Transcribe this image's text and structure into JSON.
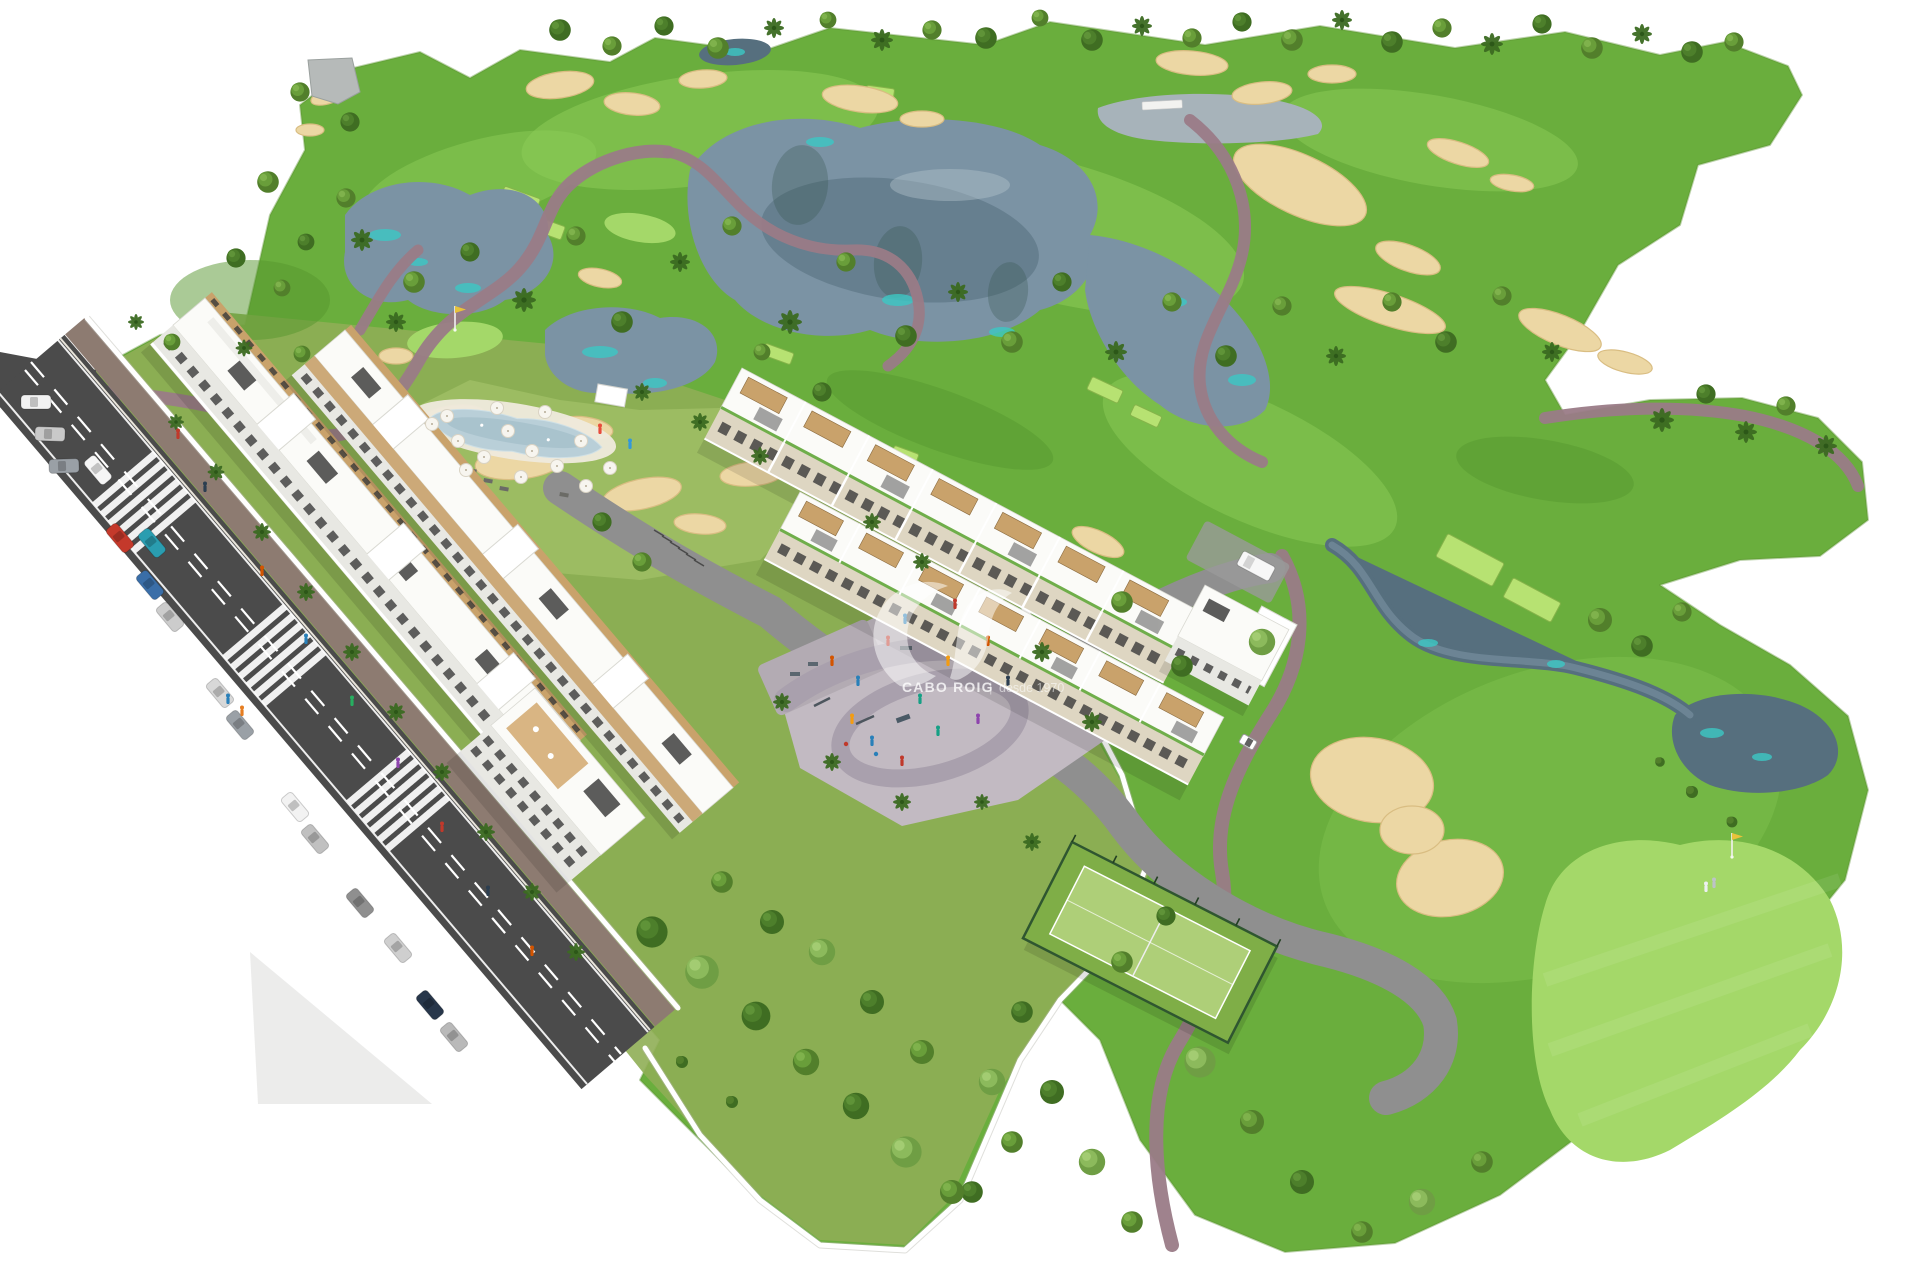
{
  "watermark": {
    "brand": "CABO ROIG",
    "divider": "|",
    "tagline": "desde 1970",
    "logo": "swoosh-logo"
  },
  "colors": {
    "grass": "#6aae3d",
    "fairway": "#8ccc58",
    "rough": "#55962e",
    "lawn": "#8fae55",
    "lawn2": "#9cbc62",
    "green": "#a4d869",
    "tee": "#b7e272",
    "sand": "#ecd7a4",
    "sandedge": "#d9bd82",
    "water": "#7b93a4",
    "waterdeep": "#566f7e",
    "teal": "#3cc8c4",
    "pathm": "#9a7b87",
    "road": "#4b4b4b",
    "sidewalk": "#8d7b71",
    "plaza": "#c2bac2",
    "plazapath": "#a9a0ad",
    "court": "#7fae47",
    "courtin": "#aecf78",
    "fence": "#2f5630",
    "balcony": "#c9a26b",
    "window": "#3a3a3a",
    "roofbox": "#3f3f3f",
    "pool": "#b9cfd8",
    "deck": "#efeadd",
    "drive": "#8f8f8f",
    "wall": "#ffffff",
    "building": "#fbfbf8",
    "flag": "#e8c33a"
  },
  "scene": {
    "trees": [
      [
        "d",
        560,
        30,
        0.9
      ],
      [
        "m",
        612,
        46,
        0.8
      ],
      [
        "d",
        664,
        26,
        0.8
      ],
      [
        "m",
        718,
        48,
        0.9
      ],
      [
        "p",
        774,
        28,
        1.0
      ],
      [
        "m",
        828,
        20,
        0.7
      ],
      [
        "p",
        882,
        40,
        1.1
      ],
      [
        "m",
        932,
        30,
        0.8
      ],
      [
        "d",
        986,
        38,
        0.9
      ],
      [
        "m",
        1040,
        18,
        0.7
      ],
      [
        "d",
        1092,
        40,
        0.9
      ],
      [
        "p",
        1142,
        26,
        1.0
      ],
      [
        "m",
        1192,
        38,
        0.8
      ],
      [
        "d",
        1242,
        22,
        0.8
      ],
      [
        "m",
        1292,
        40,
        0.9
      ],
      [
        "p",
        1342,
        20,
        1.0
      ],
      [
        "d",
        1392,
        42,
        0.9
      ],
      [
        "m",
        1442,
        28,
        0.8
      ],
      [
        "p",
        1492,
        44,
        1.1
      ],
      [
        "d",
        1542,
        24,
        0.8
      ],
      [
        "m",
        1592,
        48,
        0.9
      ],
      [
        "p",
        1642,
        34,
        1.0
      ],
      [
        "d",
        1692,
        52,
        0.9
      ],
      [
        "m",
        1734,
        42,
        0.8
      ],
      [
        "m",
        300,
        92,
        0.8
      ],
      [
        "d",
        350,
        122,
        0.8
      ],
      [
        "m",
        268,
        182,
        0.9
      ],
      [
        "d",
        236,
        258,
        0.8
      ],
      [
        "m",
        282,
        288,
        0.7
      ],
      [
        "p",
        362,
        240,
        1.1
      ],
      [
        "m",
        414,
        282,
        0.9
      ],
      [
        "d",
        470,
        252,
        0.8
      ],
      [
        "p",
        524,
        300,
        1.2
      ],
      [
        "m",
        576,
        236,
        0.8
      ],
      [
        "d",
        622,
        322,
        0.9
      ],
      [
        "p",
        680,
        262,
        1.0
      ],
      [
        "m",
        732,
        226,
        0.8
      ],
      [
        "p",
        790,
        322,
        1.2
      ],
      [
        "m",
        846,
        262,
        0.8
      ],
      [
        "d",
        906,
        336,
        0.9
      ],
      [
        "p",
        958,
        292,
        1.0
      ],
      [
        "m",
        1012,
        342,
        0.9
      ],
      [
        "d",
        1062,
        282,
        0.8
      ],
      [
        "p",
        1116,
        352,
        1.1
      ],
      [
        "m",
        1172,
        302,
        0.8
      ],
      [
        "d",
        1226,
        356,
        0.9
      ],
      [
        "m",
        1282,
        306,
        0.8
      ],
      [
        "p",
        1336,
        356,
        1.0
      ],
      [
        "m",
        1392,
        302,
        0.8
      ],
      [
        "d",
        1446,
        342,
        0.9
      ],
      [
        "m",
        1502,
        296,
        0.8
      ],
      [
        "p",
        1552,
        352,
        1.0
      ],
      [
        "m",
        346,
        198,
        0.8
      ],
      [
        "p",
        396,
        322,
        1.0
      ],
      [
        "d",
        306,
        242,
        0.7
      ],
      [
        "p",
        1662,
        420,
        1.2
      ],
      [
        "d",
        1706,
        394,
        0.8
      ],
      [
        "p",
        1746,
        432,
        1.1
      ],
      [
        "m",
        1786,
        406,
        0.8
      ],
      [
        "p",
        1826,
        446,
        1.1
      ],
      [
        "m",
        1600,
        620,
        1.0
      ],
      [
        "d",
        1642,
        646,
        0.9
      ],
      [
        "m",
        1682,
        612,
        0.8
      ],
      [
        "l",
        1262,
        642,
        1.1
      ],
      [
        "m",
        1122,
        602,
        0.9
      ],
      [
        "d",
        1182,
        666,
        0.9
      ],
      [
        "l",
        1200,
        1062,
        1.3
      ],
      [
        "m",
        1252,
        1122,
        1.0
      ],
      [
        "d",
        1302,
        1182,
        1.0
      ],
      [
        "m",
        1362,
        1232,
        0.9
      ],
      [
        "l",
        1422,
        1202,
        1.1
      ],
      [
        "m",
        1482,
        1162,
        0.9
      ],
      [
        "b",
        1692,
        792,
        1.0
      ],
      [
        "b",
        1732,
        822,
        0.9
      ],
      [
        "b",
        1660,
        762,
        0.8
      ],
      [
        "d",
        1052,
        1092,
        1.0
      ],
      [
        "m",
        1012,
        1142,
        0.9
      ],
      [
        "d",
        972,
        1192,
        0.9
      ],
      [
        "l",
        1092,
        1162,
        1.1
      ],
      [
        "m",
        1132,
        1222,
        0.9
      ],
      [
        "d",
        652,
        932,
        1.3
      ],
      [
        "l",
        702,
        972,
        1.4
      ],
      [
        "d",
        756,
        1016,
        1.2
      ],
      [
        "m",
        806,
        1062,
        1.1
      ],
      [
        "d",
        856,
        1106,
        1.1
      ],
      [
        "l",
        906,
        1152,
        1.3
      ],
      [
        "m",
        952,
        1192,
        1.0
      ],
      [
        "d",
        872,
        1002,
        1.0
      ],
      [
        "m",
        922,
        1052,
        1.0
      ],
      [
        "l",
        822,
        952,
        1.1
      ],
      [
        "d",
        772,
        922,
        1.0
      ],
      [
        "m",
        722,
        882,
        0.9
      ],
      [
        "b",
        682,
        1062,
        1.0
      ],
      [
        "b",
        732,
        1102,
        1.0
      ],
      [
        "l",
        992,
        1082,
        1.1
      ],
      [
        "d",
        1022,
        1012,
        0.9
      ],
      [
        "p",
        176,
        422,
        0.8
      ],
      [
        "p",
        216,
        472,
        0.85
      ],
      [
        "p",
        262,
        532,
        0.9
      ],
      [
        "p",
        306,
        592,
        0.9
      ],
      [
        "p",
        352,
        652,
        0.9
      ],
      [
        "p",
        396,
        712,
        0.9
      ],
      [
        "p",
        442,
        772,
        0.9
      ],
      [
        "p",
        486,
        832,
        0.9
      ],
      [
        "p",
        532,
        892,
        0.9
      ],
      [
        "p",
        576,
        952,
        0.9
      ],
      [
        "p",
        136,
        322,
        0.8
      ],
      [
        "m",
        172,
        342,
        0.7
      ],
      [
        "p",
        244,
        348,
        0.85
      ],
      [
        "m",
        302,
        354,
        0.7
      ],
      [
        "p",
        642,
        392,
        0.9
      ],
      [
        "p",
        700,
        422,
        0.9
      ],
      [
        "p",
        760,
        456,
        0.9
      ],
      [
        "d",
        602,
        522,
        0.8
      ],
      [
        "m",
        642,
        562,
        0.8
      ],
      [
        "p",
        872,
        522,
        0.9
      ],
      [
        "p",
        922,
        562,
        0.9
      ],
      [
        "p",
        1042,
        652,
        1.0
      ],
      [
        "p",
        1092,
        722,
        1.0
      ],
      [
        "p",
        832,
        762,
        0.9
      ],
      [
        "p",
        782,
        702,
        0.9
      ],
      [
        "p",
        902,
        802,
        0.9
      ],
      [
        "m",
        762,
        352,
        0.7
      ],
      [
        "d",
        822,
        392,
        0.8
      ],
      [
        "p",
        1032,
        842,
        0.9
      ],
      [
        "p",
        982,
        802,
        0.8
      ],
      [
        "m",
        1122,
        962,
        0.9
      ],
      [
        "d",
        1166,
        916,
        0.8
      ]
    ],
    "bunkers": [
      [
        560,
        85,
        34,
        13,
        -8
      ],
      [
        632,
        104,
        28,
        11,
        6
      ],
      [
        703,
        79,
        24,
        9,
        -4
      ],
      [
        860,
        99,
        38,
        13,
        8
      ],
      [
        922,
        119,
        22,
        8,
        0
      ],
      [
        1192,
        63,
        36,
        12,
        5
      ],
      [
        1262,
        93,
        30,
        11,
        -6
      ],
      [
        1332,
        74,
        24,
        9,
        0
      ],
      [
        1458,
        153,
        32,
        11,
        18
      ],
      [
        1512,
        183,
        22,
        8,
        10
      ],
      [
        1560,
        330,
        44,
        15,
        22
      ],
      [
        1625,
        362,
        28,
        10,
        15
      ],
      [
        1300,
        185,
        72,
        30,
        25
      ],
      [
        1408,
        258,
        34,
        13,
        20
      ],
      [
        450,
        420,
        36,
        14,
        -10
      ],
      [
        520,
        462,
        45,
        17,
        -6
      ],
      [
        585,
        428,
        28,
        11,
        8
      ],
      [
        642,
        494,
        40,
        15,
        -12
      ],
      [
        700,
        524,
        26,
        10,
        5
      ],
      [
        752,
        474,
        32,
        12,
        -5
      ],
      [
        396,
        356,
        17,
        8,
        0
      ],
      [
        600,
        278,
        22,
        9,
        12
      ],
      [
        330,
        95,
        20,
        8,
        -20
      ],
      [
        310,
        130,
        14,
        6,
        0
      ],
      [
        1390,
        310,
        58,
        16,
        18
      ],
      [
        1372,
        780,
        62,
        42,
        10
      ],
      [
        1450,
        878,
        54,
        38,
        -12
      ],
      [
        1412,
        830,
        32,
        24,
        0
      ],
      [
        1098,
        542,
        28,
        11,
        25
      ]
    ],
    "teal_patches": [
      [
        385,
        235,
        16,
        6
      ],
      [
        468,
        288,
        13,
        5
      ],
      [
        600,
        352,
        18,
        6
      ],
      [
        655,
        383,
        12,
        5
      ],
      [
        820,
        142,
        14,
        5
      ],
      [
        898,
        300,
        16,
        6
      ],
      [
        1002,
        332,
        13,
        5
      ],
      [
        1175,
        302,
        12,
        5
      ],
      [
        1242,
        380,
        14,
        6
      ],
      [
        418,
        262,
        10,
        4
      ],
      [
        1712,
        733,
        12,
        5
      ],
      [
        1762,
        757,
        10,
        4
      ],
      [
        1428,
        643,
        10,
        4
      ],
      [
        1556,
        664,
        9,
        4
      ],
      [
        735,
        52,
        10,
        4
      ]
    ],
    "tees": [
      [
        1470,
        560,
        64,
        26,
        28
      ],
      [
        1532,
        600,
        54,
        22,
        28
      ],
      [
        520,
        200,
        38,
        16,
        20
      ],
      [
        548,
        228,
        32,
        14,
        20
      ],
      [
        880,
        93,
        28,
        12,
        8
      ],
      [
        1105,
        390,
        34,
        14,
        25
      ],
      [
        1146,
        416,
        30,
        12,
        25
      ],
      [
        778,
        354,
        30,
        12,
        20
      ],
      [
        905,
        455,
        26,
        11,
        20
      ]
    ],
    "umbrellas": [
      [
        432,
        424
      ],
      [
        458,
        441
      ],
      [
        484,
        457
      ],
      [
        508,
        431
      ],
      [
        532,
        451
      ],
      [
        557,
        466
      ],
      [
        581,
        441
      ],
      [
        466,
        470
      ],
      [
        521,
        477
      ],
      [
        447,
        416
      ],
      [
        610,
        468
      ],
      [
        586,
        486
      ],
      [
        545,
        412
      ],
      [
        497,
        408
      ]
    ],
    "cars": [
      [
        36,
        402,
        0,
        "#f2f2f2",
        "c"
      ],
      [
        50,
        434,
        2,
        "#c9c9c9",
        "c"
      ],
      [
        64,
        466,
        -2,
        "#9aa0a6",
        "c"
      ],
      [
        98,
        470,
        50,
        "#f5f5f5",
        "c"
      ],
      [
        120,
        538,
        50,
        "#c4392b",
        "c"
      ],
      [
        152,
        543,
        50,
        "#2a9db0",
        "c"
      ],
      [
        150,
        585,
        50,
        "#3a6ea8",
        "c"
      ],
      [
        170,
        617,
        50,
        "#cccccc",
        "c"
      ],
      [
        220,
        693,
        50,
        "#d8d8d8",
        "c"
      ],
      [
        240,
        725,
        50,
        "#9aa0a6",
        "c"
      ],
      [
        295,
        807,
        50,
        "#f2f2f2",
        "c"
      ],
      [
        315,
        839,
        50,
        "#c0c0c0",
        "c"
      ],
      [
        360,
        903,
        50,
        "#8f8f8f",
        "c"
      ],
      [
        398,
        948,
        50,
        "#cfcfcf",
        "c"
      ],
      [
        430,
        1005,
        50,
        "#27364a",
        "c"
      ],
      [
        454,
        1037,
        50,
        "#b9b9b9",
        "c"
      ],
      [
        1256,
        566,
        28,
        "#f7f7f7",
        "v"
      ],
      [
        1248,
        742,
        30,
        "#ffffff",
        "g"
      ]
    ],
    "people": [
      [
        178,
        435,
        "#c0392b"
      ],
      [
        205,
        488,
        "#2c3e50"
      ],
      [
        262,
        572,
        "#d35400"
      ],
      [
        306,
        640,
        "#2980b9"
      ],
      [
        352,
        702,
        "#27ae60"
      ],
      [
        398,
        764,
        "#8e44ad"
      ],
      [
        442,
        828,
        "#c0392b"
      ],
      [
        488,
        892,
        "#2c3e50"
      ],
      [
        532,
        952,
        "#d35400"
      ],
      [
        228,
        700,
        "#2980b9"
      ],
      [
        242,
        712,
        "#e67e22"
      ],
      [
        832,
        662,
        "#d35400"
      ],
      [
        858,
        682,
        "#2980b9"
      ],
      [
        888,
        642,
        "#c0392b"
      ],
      [
        920,
        700,
        "#16a085"
      ],
      [
        948,
        662,
        "#f39c12"
      ],
      [
        978,
        720,
        "#8e44ad"
      ],
      [
        1008,
        682,
        "#2c3e50"
      ],
      [
        872,
        742,
        "#2980b9"
      ],
      [
        902,
        762,
        "#c0392b"
      ],
      [
        938,
        732,
        "#16a085"
      ],
      [
        852,
        720,
        "#f39c12"
      ],
      [
        988,
        642,
        "#d35400"
      ],
      [
        905,
        620,
        "#2980b9"
      ],
      [
        955,
        605,
        "#c0392b"
      ],
      [
        1706,
        888,
        "#ecf0f1"
      ],
      [
        1714,
        884,
        "#bdc3c7"
      ],
      [
        600,
        430,
        "#e74c3c"
      ],
      [
        630,
        445,
        "#3498db"
      ]
    ],
    "flags": [
      [
        455,
        330
      ],
      [
        1732,
        857
      ]
    ]
  }
}
